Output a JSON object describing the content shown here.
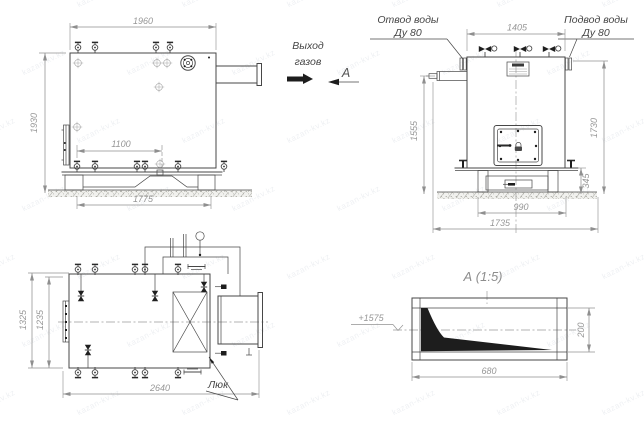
{
  "drawing": {
    "watermark": "kazan-kv.kz",
    "section_title": "А  (1:5)",
    "labels": {
      "gas_outlet_line1": "Выход",
      "gas_outlet_line2": "газов",
      "section_mark": "А",
      "water_outlet_title": "Отвод воды",
      "water_outlet_dn": "Ду 80",
      "water_inlet_title": "Подвод воды",
      "water_inlet_dn": "Ду 80",
      "hatch": "Люк",
      "elevation_mark": "+1575"
    },
    "dimensions": {
      "side_view": {
        "overall_width": "1960",
        "overall_height": "1930",
        "anchor_spacing": "1100",
        "base_width": "1775"
      },
      "front_view": {
        "top_width": "1405",
        "left_height": "1555",
        "right_height": "1730",
        "base_height": "345",
        "base_inner_width": "990",
        "overall_width": "1735"
      },
      "plan_view": {
        "overall_depth": "1325",
        "inner_depth": "1235",
        "overall_length": "2640"
      },
      "section_a": {
        "duct_height": "200",
        "duct_width": "680"
      }
    }
  }
}
